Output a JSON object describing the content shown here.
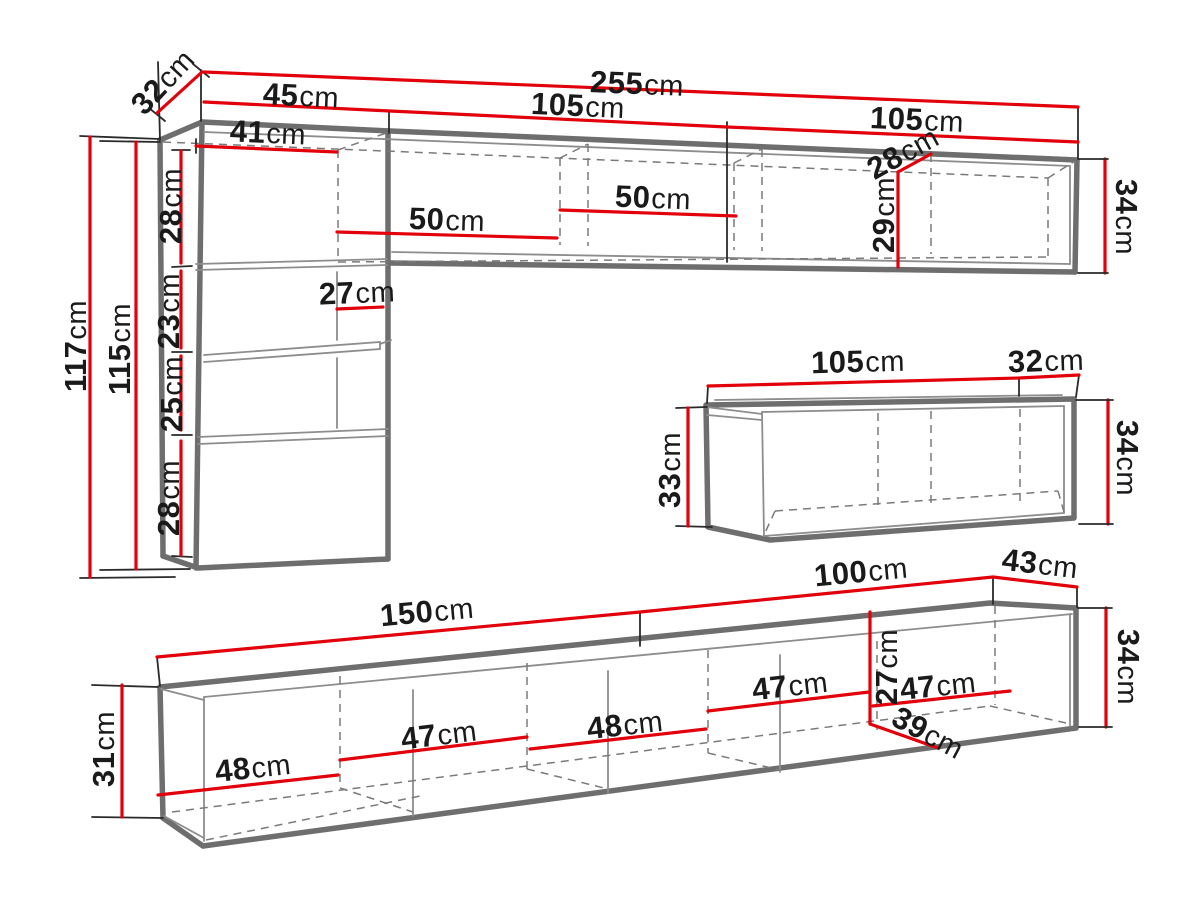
{
  "diagram_title": "wall-unit-furniture-dimensions",
  "colors": {
    "dimension_line": "#e2000b",
    "furniture_outline": "#6e6e6e",
    "label_text": "#1a1a1a",
    "background": "#ffffff"
  },
  "labels": {
    "top_depth_32": {
      "num": "32",
      "unit": "cm"
    },
    "top_total_255": {
      "num": "255",
      "unit": "cm"
    },
    "top_left_45": {
      "num": "45",
      "unit": "cm"
    },
    "top_mid_105": {
      "num": "105",
      "unit": "cm"
    },
    "top_right_105": {
      "num": "105",
      "unit": "cm"
    },
    "cab_inner_41": {
      "num": "41",
      "unit": "cm"
    },
    "cab_sec1_28": {
      "num": "28",
      "unit": "cm"
    },
    "cab_sec2_23": {
      "num": "23",
      "unit": "cm"
    },
    "cab_sec3_25": {
      "num": "25",
      "unit": "cm"
    },
    "cab_sec4_28": {
      "num": "28",
      "unit": "cm"
    },
    "cab_h_117": {
      "num": "117",
      "unit": "cm"
    },
    "cab_h_115": {
      "num": "115",
      "unit": "cm"
    },
    "cab_mid_27": {
      "num": "27",
      "unit": "cm"
    },
    "shelf_left_50": {
      "num": "50",
      "unit": "cm"
    },
    "shelf_right_50": {
      "num": "50",
      "unit": "cm"
    },
    "shelf_depth_28": {
      "num": "28",
      "unit": "cm"
    },
    "shelf_inner_29": {
      "num": "29",
      "unit": "cm"
    },
    "shelf_h_34": {
      "num": "34",
      "unit": "cm"
    },
    "mid_w_105": {
      "num": "105",
      "unit": "cm"
    },
    "mid_d_32": {
      "num": "32",
      "unit": "cm"
    },
    "mid_h_33": {
      "num": "33",
      "unit": "cm"
    },
    "mid_h_34": {
      "num": "34",
      "unit": "cm"
    },
    "bot_w_150": {
      "num": "150",
      "unit": "cm"
    },
    "bot_w_100": {
      "num": "100",
      "unit": "cm"
    },
    "bot_d_43": {
      "num": "43",
      "unit": "cm"
    },
    "bot_h_31": {
      "num": "31",
      "unit": "cm"
    },
    "bot_h_34": {
      "num": "34",
      "unit": "cm"
    },
    "bot_c1_48": {
      "num": "48",
      "unit": "cm"
    },
    "bot_c2_47": {
      "num": "47",
      "unit": "cm"
    },
    "bot_c3_48": {
      "num": "48",
      "unit": "cm"
    },
    "bot_c4_47": {
      "num": "47",
      "unit": "cm"
    },
    "bot_c5_47": {
      "num": "47",
      "unit": "cm"
    },
    "bot_inner_27": {
      "num": "27",
      "unit": "cm"
    },
    "bot_diag_39": {
      "num": "39",
      "unit": "cm"
    }
  }
}
